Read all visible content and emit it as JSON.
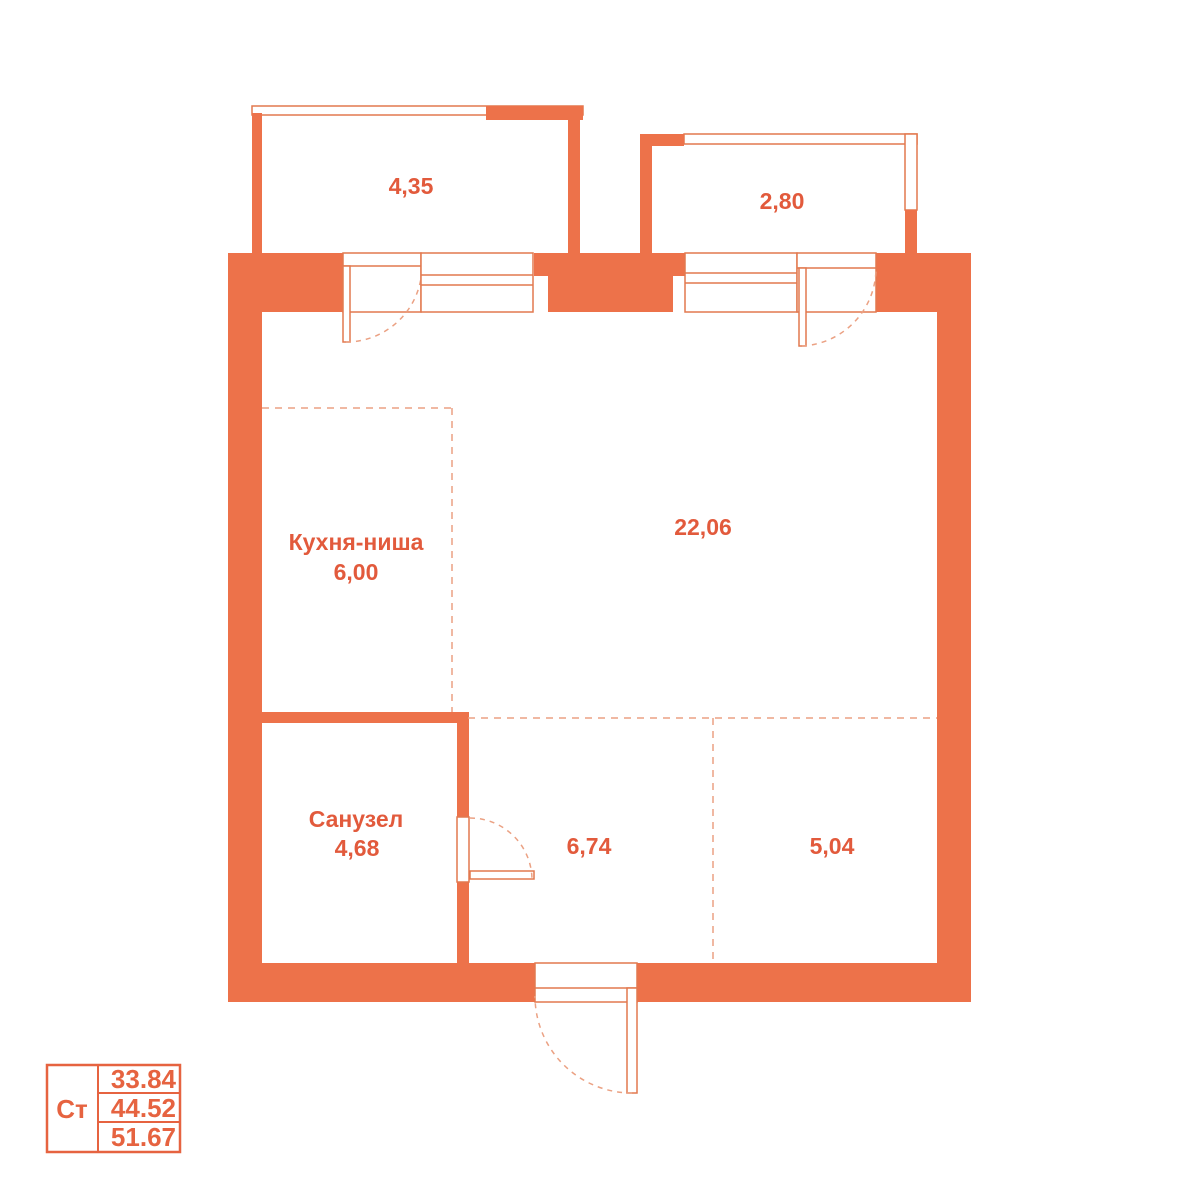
{
  "plan": {
    "balcony1": {
      "area": "4,35"
    },
    "balcony2": {
      "area": "2,80"
    },
    "kitchen": {
      "name": "Кухня-ниша",
      "area": "6,00"
    },
    "living": {
      "area": "22,06"
    },
    "bathroom": {
      "name": "Санузел",
      "area": "4,68"
    },
    "hall": {
      "area": "6,74"
    },
    "room2": {
      "area": "5,04"
    }
  },
  "legend": {
    "type_label": "Ст",
    "rows": [
      "33.84",
      "44.52",
      "51.67"
    ]
  },
  "colors": {
    "wall": "#ED724A",
    "line": "#E2794F",
    "dashed": "#EBA183",
    "label_text": "#E25A3C",
    "legend": "#E66340",
    "background": "#FFFFFF"
  }
}
